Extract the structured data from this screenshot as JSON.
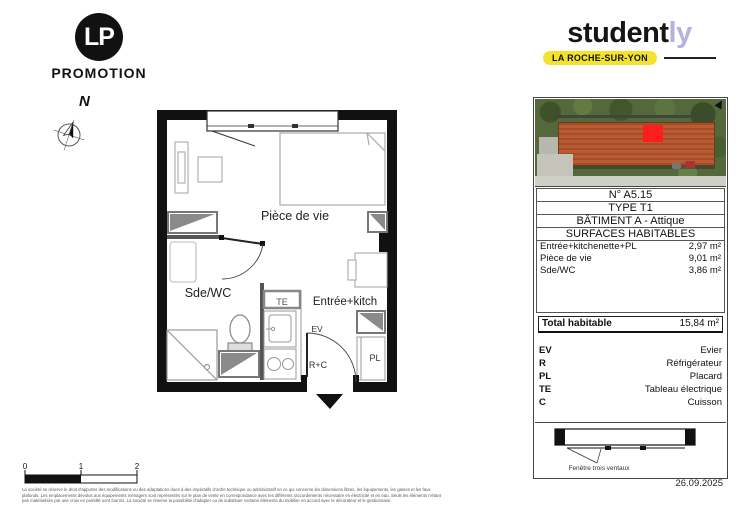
{
  "lp": {
    "monogram": "LP",
    "name": "PROMOTION"
  },
  "compass": {
    "north": "N"
  },
  "studently": {
    "word_main": "student",
    "word_accent": "ly",
    "badge": "LA ROCHE-SUR-YON",
    "accent_color": "#b4b0e0",
    "badge_color": "#f3e32c"
  },
  "photo": {
    "marker_color": "#fc1d1d"
  },
  "plan": {
    "living_label": "Pièce de vie",
    "bathroom_label": "Sde/WC",
    "entrance_label": "Entrée+kitch",
    "te": "TE",
    "ev": "EV",
    "rc": "R+C",
    "pl": "PL"
  },
  "info_rows": [
    "N° A5.15",
    "TYPE T1",
    "BÂTIMENT A - Attique",
    "SURFACES HABITABLES"
  ],
  "surfaces": {
    "items": [
      {
        "label": "Entrée+kitchenette+PL",
        "value": "2,97 m²"
      },
      {
        "label": "Pièce de vie",
        "value": "9,01 m²"
      },
      {
        "label": "Sde/WC",
        "value": "3,86 m²"
      }
    ],
    "total_label": "Total habitable",
    "total_value": "15,84 m²"
  },
  "legend": {
    "items": [
      {
        "abbr": "EV",
        "label": "Evier"
      },
      {
        "abbr": "R",
        "label": "Réfrigérateur"
      },
      {
        "abbr": "PL",
        "label": "Placard"
      },
      {
        "abbr": "TE",
        "label": "Tableau électrique"
      },
      {
        "abbr": "C",
        "label": "Cuisson"
      }
    ]
  },
  "window_caption": "Fenêtre trois ventaux",
  "scale": {
    "labels": [
      "0",
      "1",
      "2"
    ]
  },
  "date": "26.09.2025",
  "legal_lines": [
    "La société se réserve le droit d'apporter des modifications ou des adaptations dues à des impératifs d'ordre technique ou administratif en ce qui concerne les dimensions libres, les équipements, les gaines et les faux",
    "plafonds. Les emplacements dévolus aux équipements ménagers sont représentés sur le plan de vente en correspondance avec les différents raccordements nécessaire en électricité et en eau. Seuls les éléments n'étant",
    "pas matérialisés par une croix en pointillé sont fournis. La société se réserve la possibilité d'adapter ou de substituer certains éléments du mobilier en accord avec le décorateur et le gestionnaire."
  ]
}
